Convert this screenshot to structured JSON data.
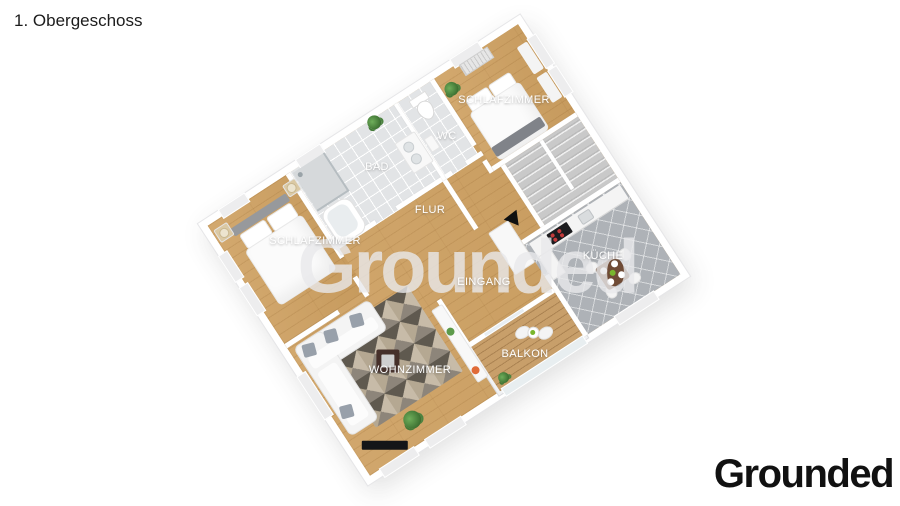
{
  "header": {
    "title": "1. Obergeschoss"
  },
  "branding": {
    "watermark": "Grounded",
    "logo": "Grounded"
  },
  "floorplan": {
    "floor_name": "1. Obergeschoss",
    "labels": {
      "schlafzimmer_top": "SCHLAFZIMMER",
      "wc": "WC",
      "bad": "BAD",
      "flur": "FLUR",
      "schlafzimmer_left": "SCHLAFZIMMER",
      "kueche": "KÜCHE",
      "eingang": "EINGANG",
      "balkon": "BALKON",
      "wohnzimmer": "WOHNZIMMER"
    },
    "colors": {
      "background": "#ffffff",
      "wall": "#ffffff",
      "wood_floor": "#cfa365",
      "bath_tile": "#e2e4e6",
      "kitchen_tile": "#aeb2b7",
      "stairs": "#cacaca",
      "balcony_deck": "#c89f6a",
      "label_text": "#ffffff",
      "logo_text": "#111111"
    }
  }
}
